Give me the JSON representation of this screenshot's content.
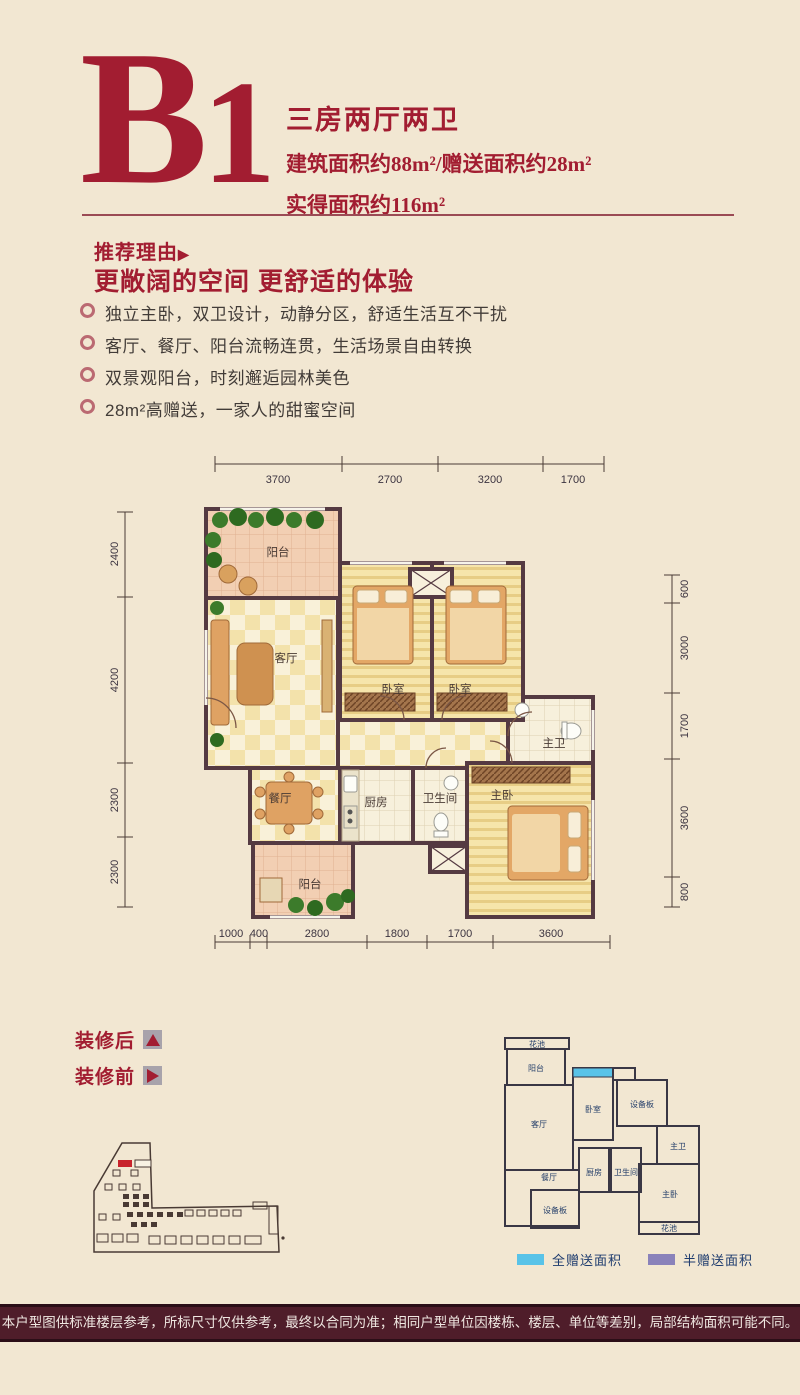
{
  "header": {
    "unit_b": "B",
    "unit_1": "1",
    "type_label": "三房两厅两卫",
    "area_line1": "建筑面积约88m²/赠送面积约28m²",
    "area_line2": "实得面积约116m²"
  },
  "recommend": {
    "title": "推荐理由",
    "title_arrow": "▶",
    "subtitle": "更敞阔的空间 更舒适的体验",
    "bullets": [
      "独立主卧，双卫设计，动静分区，舒适生活互不干扰",
      "客厅、餐厅、阳台流畅连贯，生活场景自由转换",
      "双景观阳台，时刻邂逅园林美色",
      "28m²高赠送，一家人的甜蜜空间"
    ]
  },
  "floorplan": {
    "rooms": {
      "balcony_top": "阳台",
      "living": "客厅",
      "bedroom_a": "卧室",
      "bedroom_b": "卧室",
      "master_bath": "主卫",
      "dining": "餐厅",
      "kitchen": "厨房",
      "bath": "卫生间",
      "master_bed": "主卧",
      "balcony_bottom": "阳台"
    },
    "dims_top": [
      "3700",
      "2700",
      "3200",
      "1700"
    ],
    "dims_left": [
      "2400",
      "4200",
      "2300",
      "2300"
    ],
    "dims_right": [
      "600",
      "3000",
      "1700",
      "3600",
      "800"
    ],
    "dims_bottom": [
      "1000",
      "400",
      "2800",
      "1800",
      "1700",
      "3600"
    ]
  },
  "decoration": {
    "after_label": "装修后",
    "before_label": "装修前"
  },
  "mini_plan": {
    "rooms": {
      "flower_top": "花池",
      "balcony": "阳台",
      "living": "客厅",
      "bedroom": "卧室",
      "equip_top": "设备板",
      "master_bath": "主卫",
      "dining": "餐厅",
      "kitchen": "厨房",
      "bath": "卫生间",
      "master_bed": "主卧",
      "equip_bottom": "设备板",
      "flower_bottom": "花池"
    },
    "legend": [
      {
        "label": "全赠送面积",
        "color": "#59c3e8"
      },
      {
        "label": "半赠送面积",
        "color": "#8a82ba"
      }
    ]
  },
  "footer": {
    "disclaimer": "本户型图供标准楼层参考，所标尺寸仅供参考，最终以合同为准；相同户型单位因楼栋、楼层、单位等差别，局部结构面积可能不同。"
  },
  "colors": {
    "accent": "#a21d31",
    "page_bg": "#f2e7d2",
    "footer_bg": "#4f1d2a",
    "full_gift": "#59c3e8",
    "half_gift": "#8a82ba",
    "plan_wall": "#553a42"
  }
}
